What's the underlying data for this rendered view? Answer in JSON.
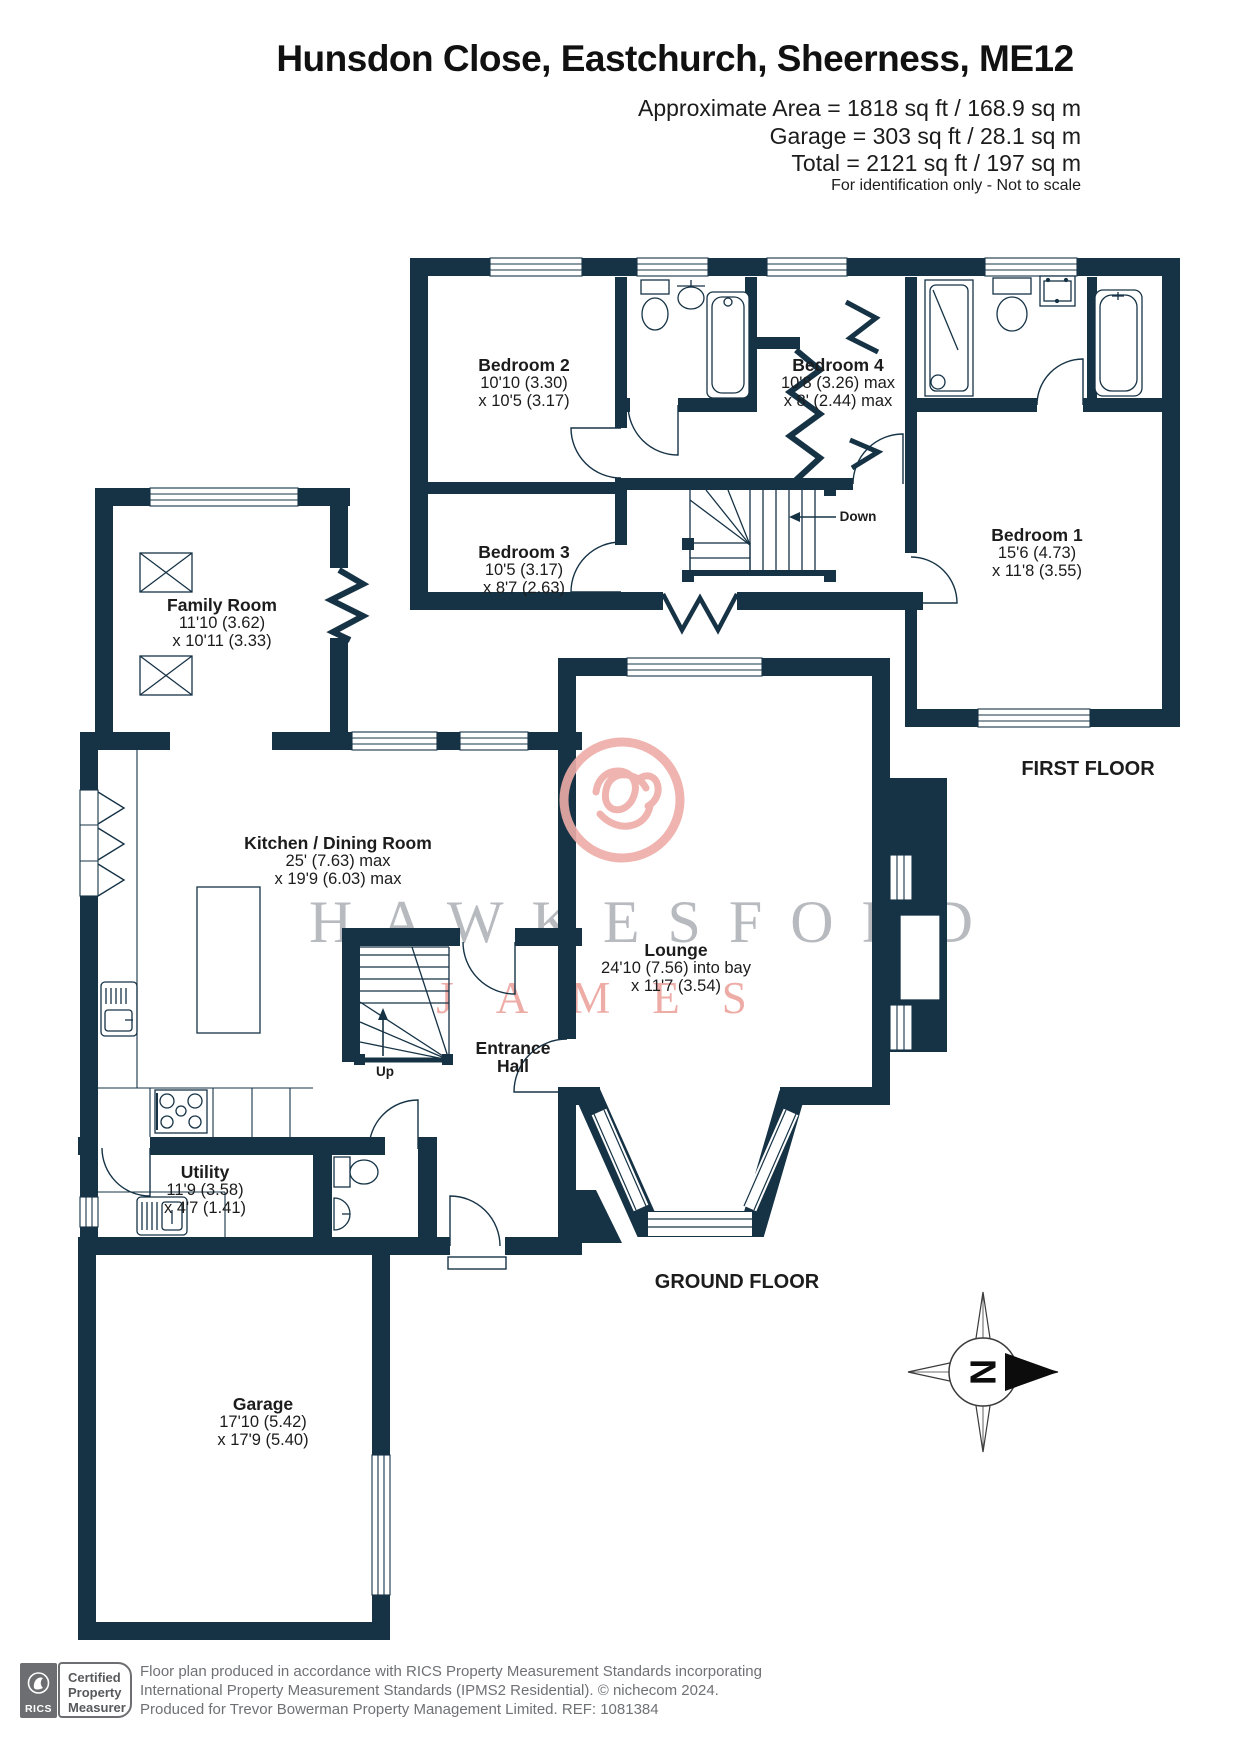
{
  "header": {
    "title": "Hunsdon Close, Eastchurch, Sheerness, ME12",
    "area_line1": "Approximate Area = 1818 sq ft / 168.9 sq m",
    "area_line2": "Garage = 303 sq ft / 28.1 sq m",
    "area_line3": "Total = 2121 sq ft / 197 sq m",
    "disclaimer": "For identification only - Not to scale"
  },
  "first_floor": {
    "label": "FIRST FLOOR",
    "bedroom2": {
      "name": "Bedroom 2",
      "dim1": "10'10 (3.30)",
      "dim2": "x 10'5 (3.17)"
    },
    "bedroom3": {
      "name": "Bedroom 3",
      "dim1": "10'5 (3.17)",
      "dim2": "x 8'7 (2.63)"
    },
    "bedroom4": {
      "name": "Bedroom 4",
      "dim1": "10'8 (3.26) max",
      "dim2": "x 8' (2.44) max"
    },
    "bedroom1": {
      "name": "Bedroom 1",
      "dim1": "15'6 (4.73)",
      "dim2": "x 11'8 (3.55)"
    },
    "stair_label": "Down"
  },
  "ground_floor": {
    "label": "GROUND FLOOR",
    "family_room": {
      "name": "Family Room",
      "dim1": "11'10 (3.62)",
      "dim2": "x 10'11 (3.33)"
    },
    "kitchen": {
      "name": "Kitchen / Dining Room",
      "dim1": "25' (7.63) max",
      "dim2": "x 19'9 (6.03) max"
    },
    "lounge": {
      "name": "Lounge",
      "dim1": "24'10 (7.56) into bay",
      "dim2": "x 11'7 (3.54)"
    },
    "entrance_hall": {
      "line1": "Entrance",
      "line2": "Hall"
    },
    "utility": {
      "name": "Utility",
      "dim1": "11'9 (3.58)",
      "dim2": "x 4'7 (1.41)"
    },
    "garage": {
      "name": "Garage",
      "dim1": "17'10 (5.42)",
      "dim2": "x 17'9 (5.40)"
    },
    "stair_label": "Up"
  },
  "watermark": {
    "line1": "HAWKESFORD",
    "line2": "JAMES"
  },
  "compass": {
    "north": "N"
  },
  "footer": {
    "rics": "RICS",
    "badge1": "Certified",
    "badge2": "Property",
    "badge3": "Measurer",
    "line1": "Floor plan produced in accordance with RICS Property Measurement Standards incorporating",
    "line2": "International Property Measurement Standards (IPMS2 Residential).   © nichecom 2024.",
    "line3": "Produced for Trevor Bowerman Property Management Limited.   REF:  1081384"
  },
  "colors": {
    "wall": "#163346",
    "watermark_gray": "#b7babe",
    "watermark_pink": "#eeaca7",
    "footer_gray": "#6f7175"
  }
}
